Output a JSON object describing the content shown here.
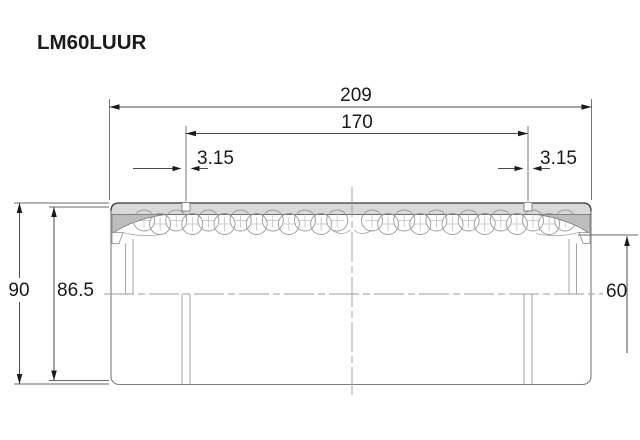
{
  "title": "LM60LUUR",
  "dimensions": {
    "overall_length": "209",
    "groove_spacing": "170",
    "groove_width_left": "3.15",
    "groove_width_right": "3.15",
    "outer_diameter": "90",
    "seal_outer_diameter": "86.5",
    "bore_diameter": "60"
  },
  "colors": {
    "background": "#ffffff",
    "shell_fill": "#d9d9d9",
    "seal_fill": "#bdbdbd",
    "body_outline": "#7f7f7f",
    "ball_outline": "#9a9a9a",
    "ball_cross": "#b8b8b8",
    "centerline": "#9e9e9e",
    "dimension_line": "#4a4a4a",
    "text": "#1a1a1a"
  }
}
